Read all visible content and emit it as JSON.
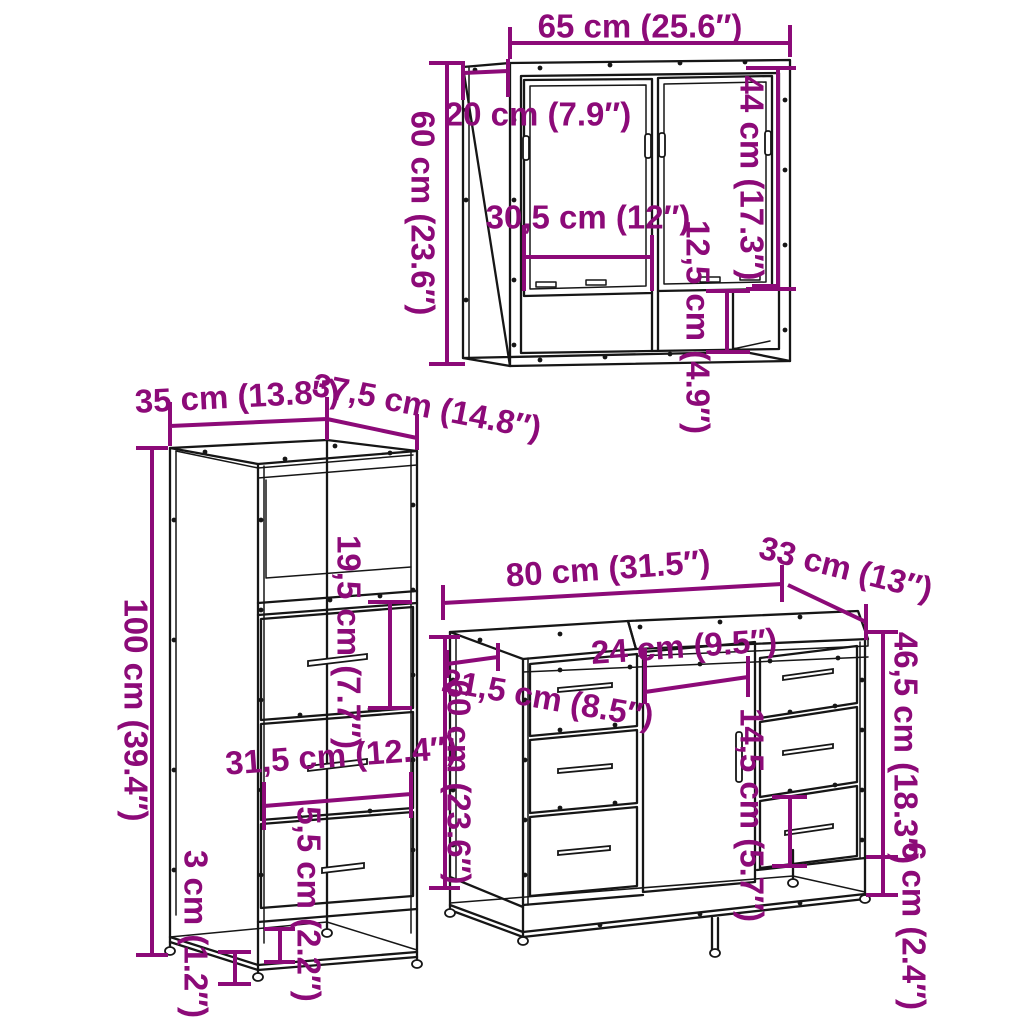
{
  "diagram_title": "3-piece bathroom furniture set dimension diagram",
  "colors": {
    "dimension_accent": "#8C0A78",
    "line_art": "#161616",
    "background": "#FFFFFF"
  },
  "mirror_cabinet": {
    "dimensions": {
      "width": "65 cm (25.6″)",
      "depth": "20 cm (7.9″)",
      "height": "60 cm (23.6″)",
      "door_height": "44 cm (17.3″)",
      "door_width": "30,5 cm (12″)",
      "open_shelf_height": "12,5 cm (4.9″)"
    }
  },
  "tall_cabinet": {
    "dimensions": {
      "width": "35 cm (13.8″)",
      "depth": "37,5 cm (14.8″)",
      "height": "100 cm (39.4″)",
      "compartment_height": "19,5 cm (7.7″)",
      "drawer_width": "31,5 cm (12.4″)",
      "bottom_gap": "5,5 cm (2.2″)",
      "base_rail_height": "3 cm (1.2″)"
    }
  },
  "vanity_cabinet": {
    "dimensions": {
      "width": "80 cm (31.5″)",
      "depth": "33 cm (13″)",
      "height": "60 cm (23.6″)",
      "side_top_depth": "21,5 cm (8.5″)",
      "door_width": "24 cm (9.5″)",
      "drawer_column_height": "46,5 cm (18.3″)",
      "drawer_height": "14,5 cm (5.7″)",
      "base_clearance": "6 cm (2.4″)"
    }
  }
}
